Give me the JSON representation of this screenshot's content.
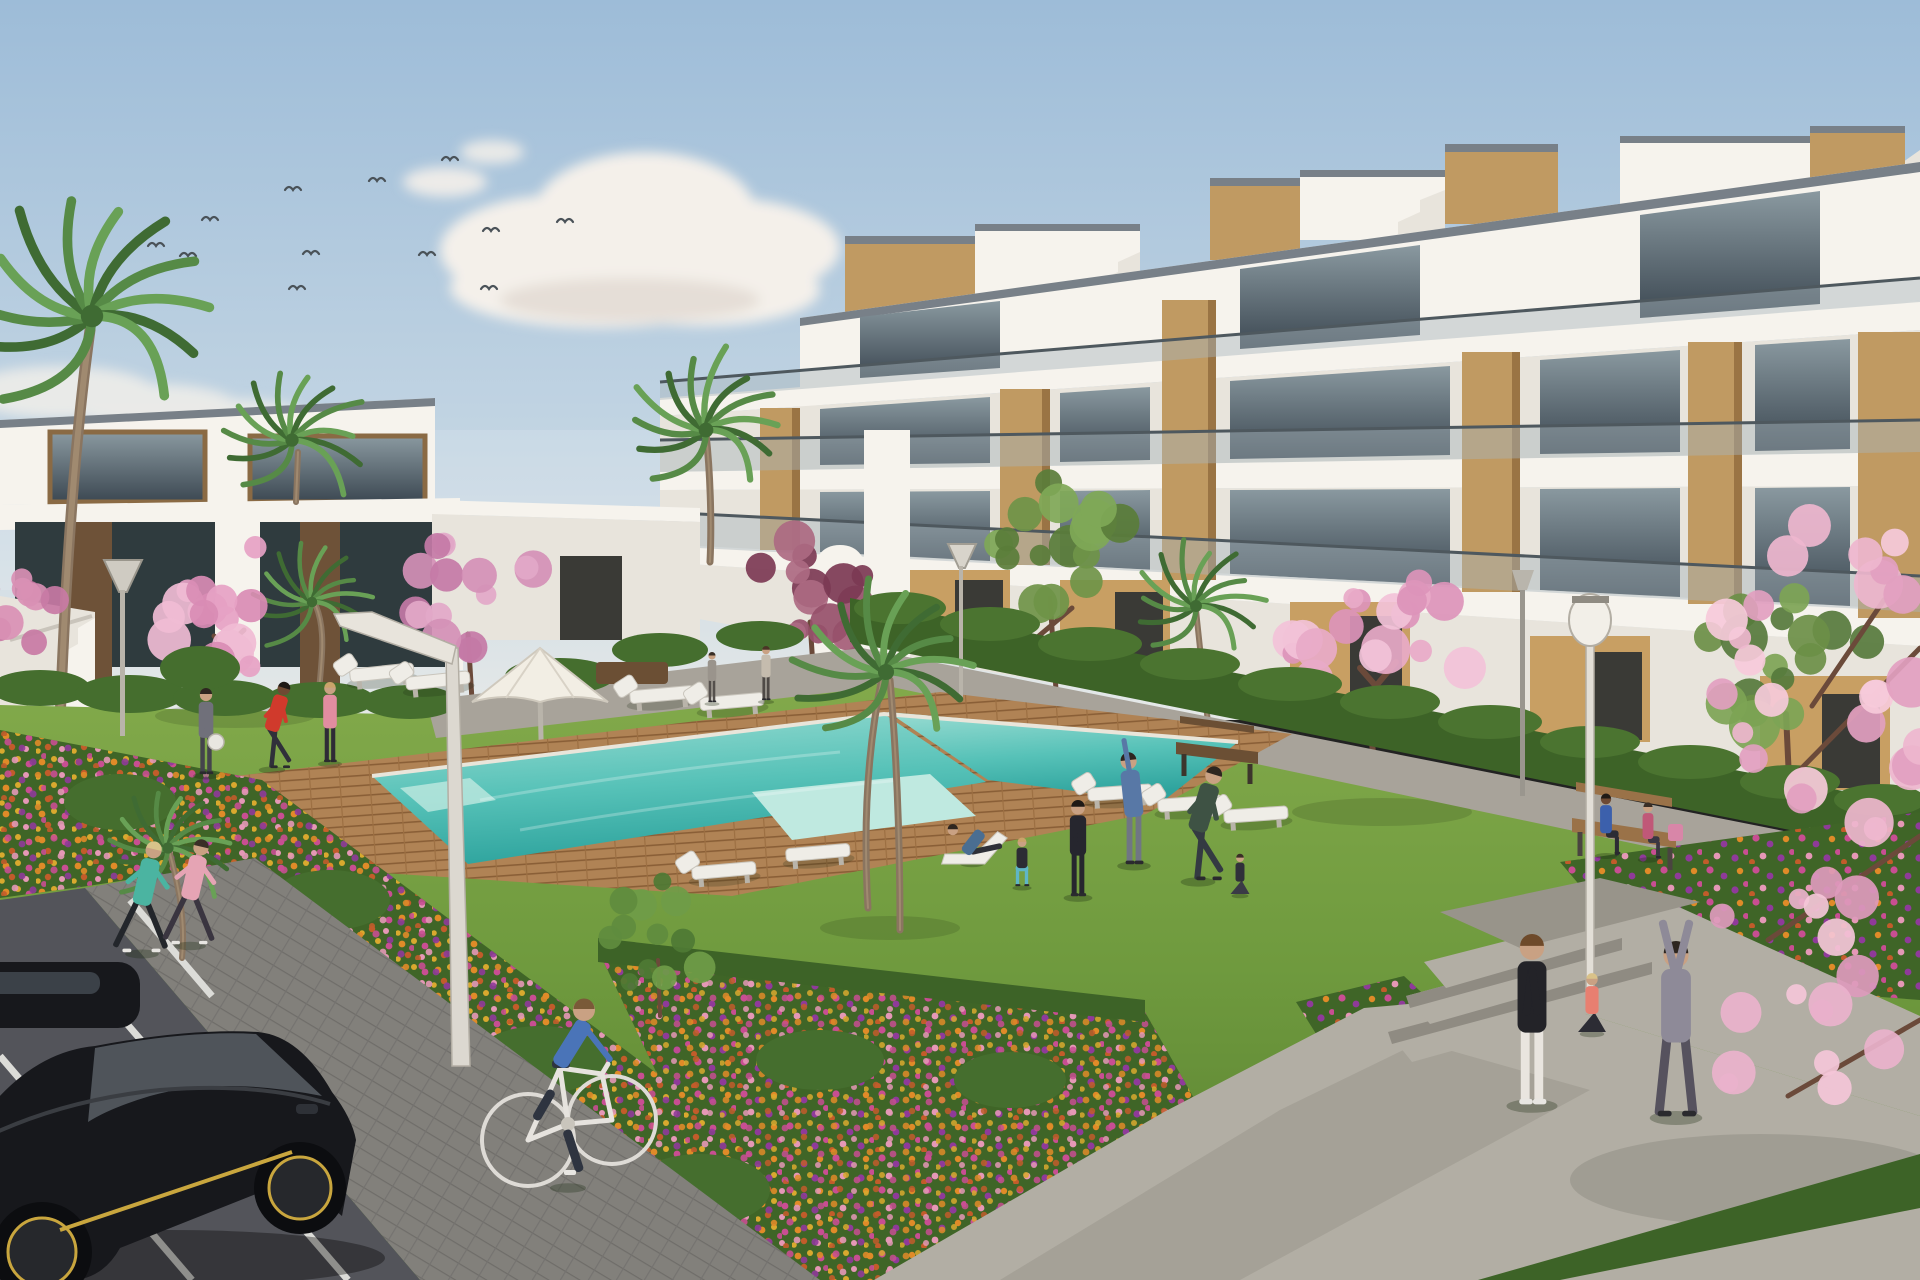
{
  "scene": {
    "kind": "architectural-rendering",
    "subject": "modern white apartment complex with communal pool, lawn and gardens",
    "width": 1920,
    "height": 1280
  },
  "palette": {
    "skyTop": "#9dbcd8",
    "skyMid": "#c3d5e3",
    "skyHorizon": "#e6e9e8",
    "cloud": "#f4f0ea",
    "cloudShade": "#d9cfc6",
    "bird": "#4a5258",
    "white": "#f6f3ed",
    "whiteShade": "#e8e4dc",
    "whiteDark": "#d7d2c9",
    "roofCap": "#788088",
    "glassTop": "#8a99a0",
    "glassBot": "#3c4852",
    "balustrade": "#a9b6bc",
    "rail": "#4e585e",
    "wood": "#c09a62",
    "woodDark": "#9a7444",
    "tan": "#c89f63",
    "doorDark": "#3a3a36",
    "leftLower": "#2f3b3e",
    "leftWood": "#6e5238",
    "hedge": "#3d6327",
    "hedgeLight": "#4b7430",
    "bush": "#456e2e",
    "bedBase": "#3f6527",
    "lawnTop": "#84ab4c",
    "lawnMid": "#6f9a3e",
    "lawnDeep": "#587f30",
    "deck": "#b08355",
    "deckLine": "#8a5f37",
    "poolFar": "#9adcd2",
    "poolMid": "#57c2b8",
    "poolNear": "#2fa49e",
    "poolLight": "#bfe9e0",
    "pathUpper": "#a8a39a",
    "walkway": "#82807b",
    "road": "#53545a",
    "roadLine": "#dcdcd8",
    "concrete": "#b2aea4",
    "concreteShade": "#98948a",
    "stepRiser": "#8f8b82",
    "carBody": "#17181c",
    "carShade": "#2e3137",
    "carGlass": "#3b4148",
    "carAccent": "#c9a63e",
    "trunk": "#8a7560",
    "palmDark": "#3f6b33",
    "palmMid": "#568a46",
    "palmLight": "#69a156",
    "parasol": "#f2eee4",
    "lounger": "#efede7",
    "benchWood": "#9a7248",
    "benchDark": "#6b4f34",
    "skin": "#c9a183",
    "flowerOrange": "#e08b28",
    "flowerGold": "#d9a92e",
    "flowerMagenta": "#c84e92",
    "flowerPink": "#e598b6",
    "flowerPurple": "#8f3a9a",
    "flowerRust": "#c25c2a"
  },
  "birds": [
    [
      293,
      190
    ],
    [
      377,
      181
    ],
    [
      450,
      160
    ],
    [
      210,
      220
    ],
    [
      156,
      246
    ],
    [
      188,
      256
    ],
    [
      311,
      254
    ],
    [
      427,
      255
    ],
    [
      491,
      231
    ],
    [
      297,
      289
    ],
    [
      489,
      289
    ],
    [
      565,
      222
    ]
  ],
  "trees": [
    {
      "name": "blossom-left",
      "layer": "bg",
      "cx": 226,
      "cy": 608,
      "spread": 82,
      "squash": 0.85,
      "count": 18,
      "rmin": 10,
      "rvar": 14,
      "colors": [
        "#e6a2c4",
        "#d98cb4",
        "#f0bcd4"
      ],
      "trunk": "M228,708 L222,650 M206,666 L244,630 M248,662 L214,636",
      "tw": 5
    },
    {
      "name": "blossom-left-2",
      "layer": "bg",
      "cx": 472,
      "cy": 590,
      "spread": 66,
      "squash": 0.9,
      "count": 15,
      "rmin": 9,
      "rvar": 12,
      "colors": [
        "#d490b6",
        "#c47aa6",
        "#e2a8c8"
      ],
      "trunk": "M472,700 L468,634",
      "tw": 5
    },
    {
      "name": "plum-tree",
      "layer": "bg",
      "cx": 816,
      "cy": 586,
      "spread": 64,
      "squash": 0.95,
      "count": 15,
      "rmin": 9,
      "rvar": 12,
      "colors": [
        "#96506a",
        "#7c3a54",
        "#ad6a82"
      ],
      "trunk": "M815,695 L810,622",
      "tw": 5
    },
    {
      "name": "green-tree-1",
      "layer": "bg",
      "cx": 1058,
      "cy": 548,
      "spread": 82,
      "squash": 0.85,
      "count": 16,
      "rmin": 10,
      "rvar": 14,
      "colors": [
        "#5a7d3a",
        "#6f9448",
        "#7fa857"
      ],
      "trunk": "M1056,690 L1050,598 M1034,640 L1072,608",
      "tw": 5
    },
    {
      "name": "green-tree-2",
      "layer": "bg",
      "cx": 1790,
      "cy": 664,
      "spread": 92,
      "squash": 0.8,
      "count": 16,
      "rmin": 11,
      "rvar": 15,
      "colors": [
        "#567a3c",
        "#6b8f46",
        "#7da455"
      ],
      "trunk": "M1790,800 L1786,714",
      "tw": 6
    },
    {
      "name": "blossom-right",
      "layer": "bg",
      "cx": 1378,
      "cy": 642,
      "spread": 92,
      "squash": 0.88,
      "count": 20,
      "rmin": 10,
      "rvar": 15,
      "colors": [
        "#e8aac8",
        "#dc94ba",
        "#f2c2d8"
      ],
      "trunk": "M1378,806 L1368,700 M1346,722 L1396,662 M1404,718 L1360,668",
      "tw": 6
    },
    {
      "name": "blossom-edge-left",
      "layer": "bg",
      "cx": 14,
      "cy": 610,
      "spread": 44,
      "squash": 1,
      "count": 10,
      "rmin": 8,
      "rvar": 10,
      "colors": [
        "#d990b4",
        "#c87aa4"
      ],
      "trunk": "",
      "tw": 4
    },
    {
      "name": "bed-tree",
      "layer": "fg",
      "cx": 662,
      "cy": 938,
      "spread": 52,
      "squash": 1.1,
      "count": 12,
      "rmin": 8,
      "rvar": 10,
      "colors": [
        "#4e7a34",
        "#5f8c3e",
        "#6f9c48"
      ],
      "trunk": "M660,1016 L658,960",
      "tw": 4
    },
    {
      "name": "blossom-foreground-upper",
      "layer": "fg",
      "cx": 1832,
      "cy": 690,
      "spread": 128,
      "squash": 1.35,
      "count": 26,
      "rmin": 10,
      "rvar": 16,
      "colors": [
        "#eeb6ce",
        "#e2a0c0",
        "#f6cada"
      ],
      "trunk": "M1920,648 L1790,780 M1884,600 L1812,706",
      "tw": 5
    },
    {
      "name": "blossom-foreground-lower",
      "layer": "fg",
      "cx": 1806,
      "cy": 1000,
      "spread": 104,
      "squash": 1.5,
      "count": 16,
      "rmin": 9,
      "rvar": 14,
      "colors": [
        "#eab2cc",
        "#dd9abc",
        "#f4c6d8"
      ],
      "trunk": "M1920,836 L1768,940 M1920,1020 L1788,1096",
      "tw": 5
    }
  ],
  "palms": [
    {
      "name": "palm-left-large",
      "layer": "bg",
      "x": 92,
      "y": 316,
      "s": 1.6,
      "trunk": "M60,722 C66,560 76,430 90,330",
      "tw": 11
    },
    {
      "name": "palm-left-2",
      "layer": "bg",
      "x": 292,
      "y": 440,
      "s": 0.95,
      "trunk": "M296,502 L298,452",
      "tw": 6
    },
    {
      "name": "palm-mid-left",
      "layer": "bg",
      "x": 312,
      "y": 602,
      "s": 0.75,
      "trunk": "M318,700 C322,660 326,630 316,606",
      "tw": 6
    },
    {
      "name": "palm-center",
      "layer": "bg",
      "x": 706,
      "y": 430,
      "s": 1.05,
      "trunk": "M710,562 C712,520 710,470 706,434",
      "tw": 7
    },
    {
      "name": "palm-bg-right",
      "layer": "bg",
      "x": 1196,
      "y": 606,
      "s": 0.85,
      "trunk": "M1210,744 C1206,700 1200,650 1196,610",
      "tw": 6
    },
    {
      "name": "palm-lawn",
      "layer": "fg",
      "x": 886,
      "y": 672,
      "s": 1.15,
      "trunk": "M868,908 C862,810 870,736 882,678 M900,930 C900,830 896,748 890,680",
      "tw": 7
    },
    {
      "name": "palm-pool",
      "layer": "fg",
      "x": 168,
      "y": 848,
      "s": 0.8,
      "trunk": "M182,958 C186,920 178,884 170,854",
      "tw": 6
    }
  ],
  "loungers": [
    {
      "x": 382,
      "y": 674,
      "a": -6
    },
    {
      "x": 438,
      "y": 682,
      "a": -6
    },
    {
      "x": 662,
      "y": 696,
      "a": -5
    },
    {
      "x": 732,
      "y": 703,
      "a": -5
    },
    {
      "x": 1120,
      "y": 794,
      "a": -4
    },
    {
      "x": 1190,
      "y": 805,
      "a": -4
    },
    {
      "x": 1256,
      "y": 816,
      "a": -4
    },
    {
      "x": 302,
      "y": 888,
      "a": -3,
      "flat": 1
    },
    {
      "x": 374,
      "y": 898,
      "a": -3,
      "flat": 1
    },
    {
      "x": 724,
      "y": 872,
      "a": -5
    },
    {
      "x": 818,
      "y": 854,
      "a": -5,
      "flat": 1
    }
  ],
  "people": [
    {
      "name": "jogger-teal",
      "x": 142,
      "y": 952,
      "h": 112,
      "pose": "run",
      "shirt": "#4bb4a1",
      "pants": "#23262b",
      "hair": "#d8c38a",
      "shoe": "#e8e6e2"
    },
    {
      "name": "jogger-pink",
      "x": 190,
      "y": 944,
      "h": 106,
      "pose": "run",
      "shirt": "#e5a4b4",
      "pants": "#3a3540",
      "hair": "#3a2e26",
      "shoe": "#e8e6e2"
    },
    {
      "name": "man-ball",
      "x": 206,
      "y": 774,
      "h": 86,
      "pose": "stand",
      "shirt": "#70707a",
      "pants": "#44444c",
      "hair": "#2e2620"
    },
    {
      "name": "man-red-stretch",
      "x": 272,
      "y": 768,
      "h": 88,
      "pose": "stretch",
      "shirt": "#d03a2c",
      "pants": "#30303a",
      "hair": "#1f1a16",
      "skin": "#6e4a33"
    },
    {
      "name": "woman-pink",
      "x": 330,
      "y": 762,
      "h": 80,
      "pose": "stand",
      "shirt": "#e18da0",
      "pants": "#2e2b36",
      "hair": "#caa36a"
    },
    {
      "name": "walker-1",
      "x": 712,
      "y": 702,
      "h": 50,
      "pose": "stand",
      "shirt": "#9a948c",
      "pants": "#55504c",
      "hair": "#3a2e26"
    },
    {
      "name": "walker-2",
      "x": 766,
      "y": 700,
      "h": 54,
      "pose": "stand",
      "shirt": "#c5bcae",
      "pants": "#4f4a46",
      "hair": "#4a3526"
    },
    {
      "name": "man-recline",
      "x": 972,
      "y": 862,
      "h": 80,
      "pose": "recline",
      "shirt": "#4a6e92",
      "pants": "#2e3038",
      "hair": "#2e2620"
    },
    {
      "name": "woman-squat",
      "x": 1022,
      "y": 886,
      "h": 64,
      "pose": "squat",
      "shirt": "#2c2c34",
      "pants": "#5fb6c6",
      "hair": "#caa36a"
    },
    {
      "name": "person-hoodie",
      "x": 1078,
      "y": 896,
      "h": 96,
      "pose": "stand",
      "shirt": "#26262e",
      "pants": "#26262e",
      "hair": "#1f1a16"
    },
    {
      "name": "man-stretch-arm",
      "x": 1134,
      "y": 864,
      "h": 112,
      "pose": "arm-up",
      "shirt": "#5878a6",
      "pants": "#707684",
      "hair": "#2e2620"
    },
    {
      "name": "man-green",
      "x": 1198,
      "y": 880,
      "h": 116,
      "pose": "stretch",
      "shirt": "#3e5244",
      "pants": "#343a42",
      "hair": "#2e2620"
    },
    {
      "name": "woman-lotus",
      "x": 1240,
      "y": 894,
      "h": 56,
      "pose": "lotus",
      "shirt": "#30303a",
      "pants": "#3a3a46",
      "hair": "#3a2e26"
    },
    {
      "name": "cyclist",
      "x": 568,
      "y": 1186,
      "h": 120,
      "pose": "cycle",
      "shirt": "#4a74b8",
      "pants": "#2e3440",
      "hair": "#7a5a38",
      "shoe": "#e8e6e2"
    },
    {
      "name": "woman-stand-right",
      "x": 1532,
      "y": 1104,
      "h": 170,
      "pose": "stand",
      "shirt": "#232328",
      "pants": "#e9e5df",
      "hair": "#6e4a2a",
      "shoe": "#e8e6e2"
    },
    {
      "name": "woman-seated-coral",
      "x": 1592,
      "y": 1032,
      "h": 82,
      "pose": "lotus",
      "shirt": "#e87f70",
      "pants": "#2c2c34",
      "hair": "#d9c289"
    },
    {
      "name": "person-arms-up",
      "x": 1676,
      "y": 1116,
      "h": 175,
      "pose": "arms-up",
      "shirt": "#8e8a98",
      "pants": "#56525e",
      "hair": "#2e2620"
    },
    {
      "name": "bench-man",
      "x": 1606,
      "y": 854,
      "h": 74,
      "pose": "sit",
      "shirt": "#3c60ac",
      "pants": "#2c2c34",
      "hair": "#1f1a16",
      "skin": "#6e4a33"
    },
    {
      "name": "bench-woman",
      "x": 1648,
      "y": 858,
      "h": 68,
      "pose": "sit",
      "shirt": "#c05878",
      "pants": "#3a3642",
      "hair": "#3a2e26"
    }
  ]
}
